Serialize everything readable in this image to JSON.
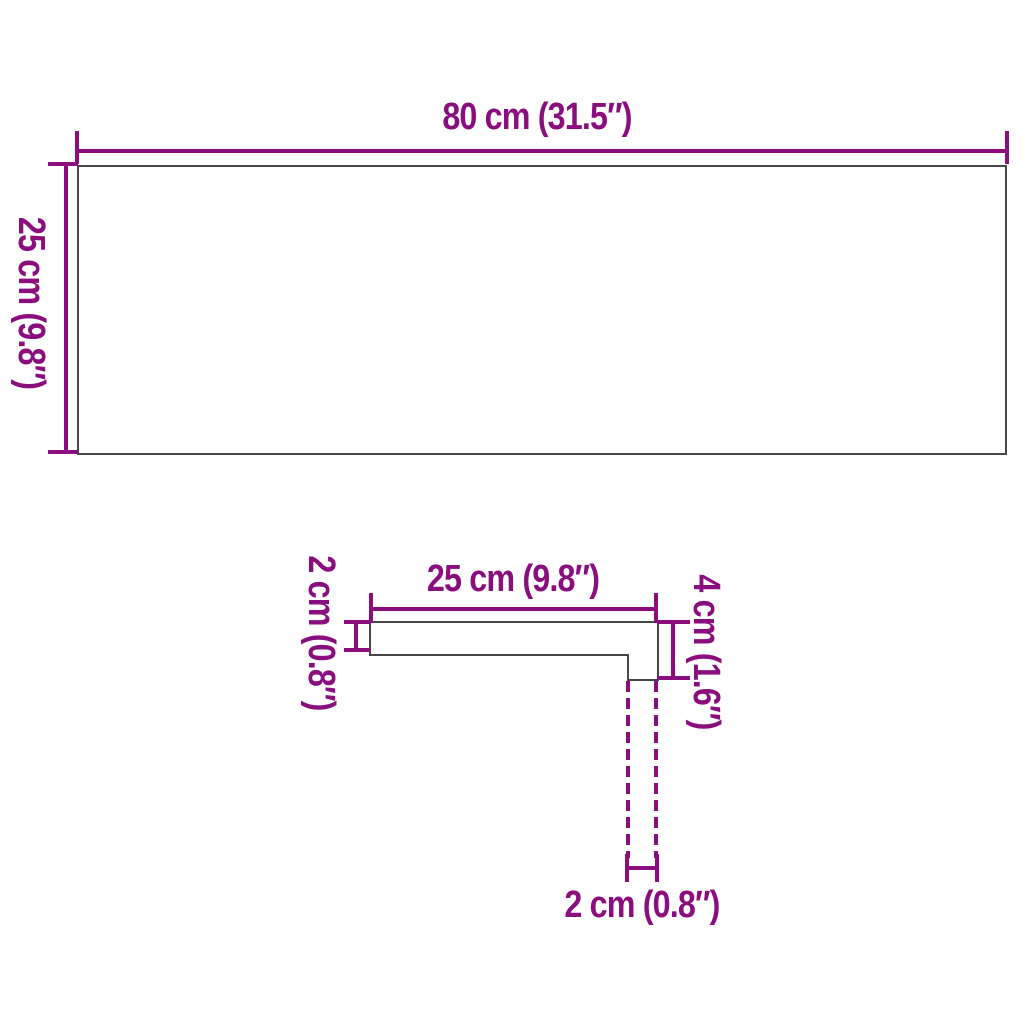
{
  "top_panel": {
    "width_label": "80 cm (31.5″)",
    "depth_label": "25 cm (9.8″)"
  },
  "profile": {
    "width_label": "25 cm (9.8″)",
    "thickness_label": "2 cm (0.8″)",
    "nose_height_label": "4 cm (1.6″)",
    "nose_thickness_label": "2 cm (0.8″)"
  },
  "colors": {
    "dimension_magenta": "#8a0e7d",
    "outline_gray": "#474747",
    "background": "#ffffff"
  }
}
